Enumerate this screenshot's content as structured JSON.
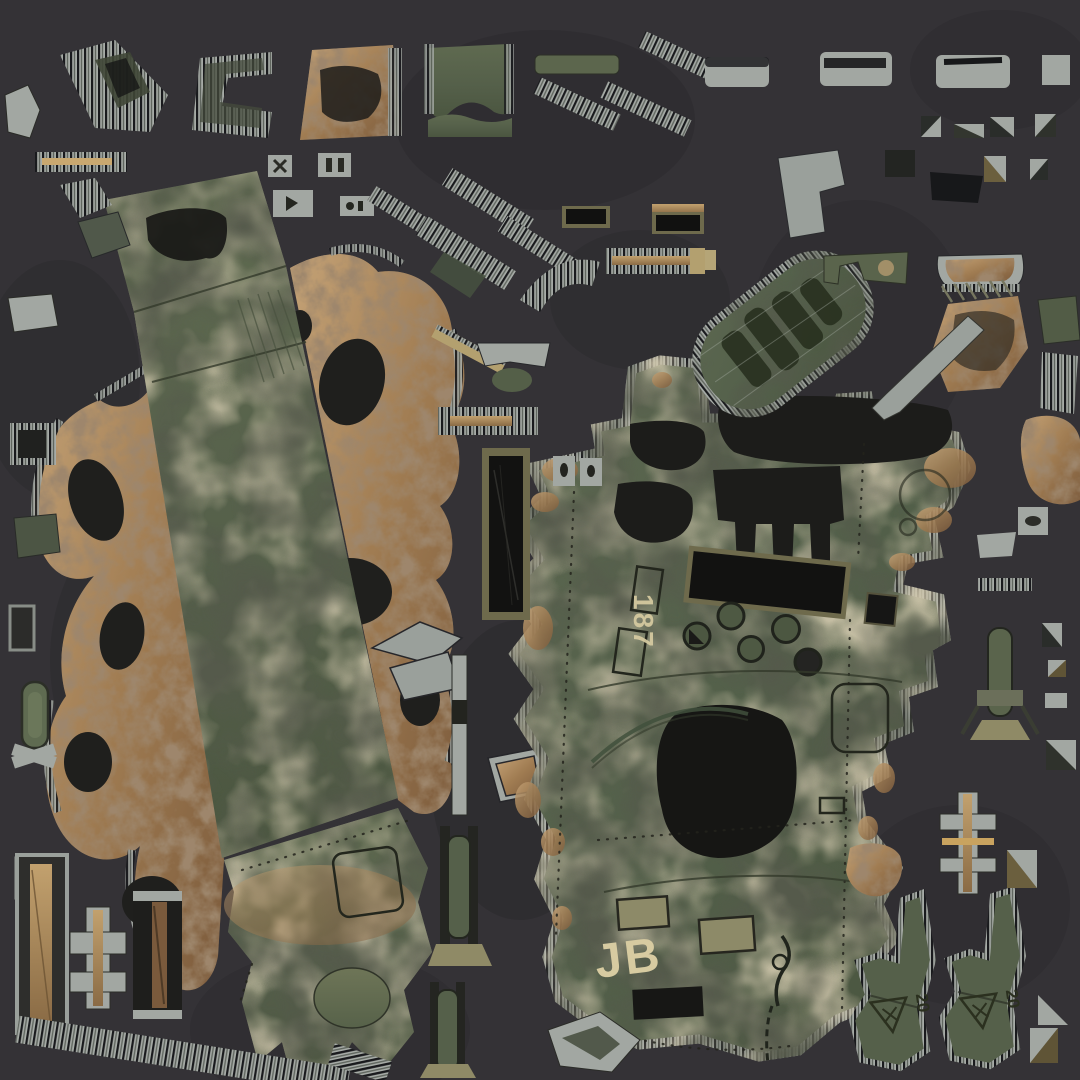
{
  "markings": {
    "hull_number": "187",
    "crew_initials": "JB",
    "load_class_left": "20",
    "load_class_right": "20"
  },
  "palette": {
    "bg": "#343236",
    "bg-blob": "#2b2a2d",
    "armor-green": "#5c6750",
    "armor-green-dark": "#49543e",
    "armor-green-light": "#6e7557",
    "mud-light": "#c5a377",
    "mud-mid": "#a07c52",
    "mud-dark": "#7c5b3c",
    "steel": "#a6aba6",
    "steel-stripe": "#191a1d",
    "panel-black": "#141412",
    "frame": "#6e6a4c",
    "stencil": "#d7cba1",
    "decal": "#2b301f"
  }
}
